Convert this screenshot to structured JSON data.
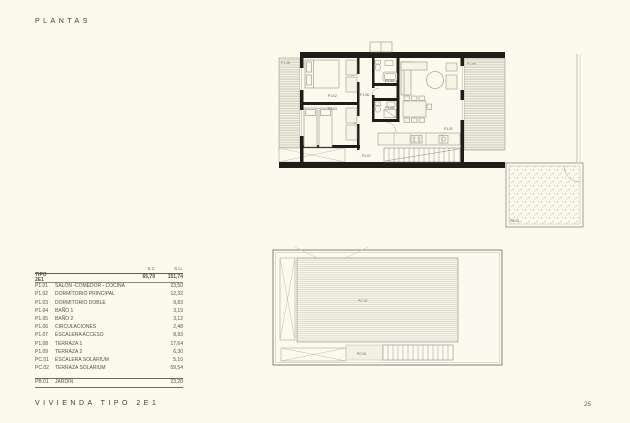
{
  "page": {
    "title": "PLANTAS",
    "footer": "VIVIENDA TIPO 2E1",
    "page_number": "25"
  },
  "colors": {
    "background": "#FBFAEC",
    "wall": "#1D1D1A",
    "text": "#3F3D36"
  },
  "table": {
    "col_sc": "S.C",
    "col_su": "S.U.",
    "tipo": {
      "code": "TIPO 2E1",
      "sc": "65,79",
      "su": "151,74"
    },
    "rows": [
      {
        "code": "P1.01",
        "label": "SALÓN -COMEDOR - COCINA",
        "su": "23,50"
      },
      {
        "code": "P1.02",
        "label": "DORMITORIO PRINCIPAL",
        "su": "12,32"
      },
      {
        "code": "P1.03",
        "label": "DORMITORIO DOBLE",
        "su": "9,83"
      },
      {
        "code": "P1.04",
        "label": "BAÑO 1",
        "su": "3,19"
      },
      {
        "code": "P1.05",
        "label": "BAÑO 2",
        "su": "3,12"
      },
      {
        "code": "P1.06",
        "label": "CIRCULACIONES",
        "su": "2,48"
      },
      {
        "code": "P1.07",
        "label": "ESCALERA ACCESO",
        "su": "8,93"
      },
      {
        "code": "P1.08",
        "label": "TERRAZA 1",
        "su": "17,64"
      },
      {
        "code": "P1.09",
        "label": "TERRAZA 2",
        "su": "6,30"
      },
      {
        "code": "PC.01",
        "label": "ESCALERA SOLARIUM",
        "su": "5,10"
      },
      {
        "code": "PC.02",
        "label": "TERRAZA SOLARIUM",
        "su": "59,54"
      }
    ],
    "garden": {
      "code": "PB.01",
      "label": "JARDÍN",
      "su": "23,20"
    }
  },
  "plans": {
    "upper": {
      "terraza_left": "P1.08",
      "terraza_right": "P1.09",
      "dormitorio_principal": "P1.02",
      "dormitorio_doble": "P1.03",
      "bano1": "P1.04",
      "bano2": "P1.05",
      "circulaciones": "P1.06",
      "salon": "P1.01",
      "escalera": "P1.07",
      "jardin": "PB.01"
    },
    "lower": {
      "terraza_solarium": "PC.02",
      "escalera_solarium": "PC.01"
    }
  }
}
